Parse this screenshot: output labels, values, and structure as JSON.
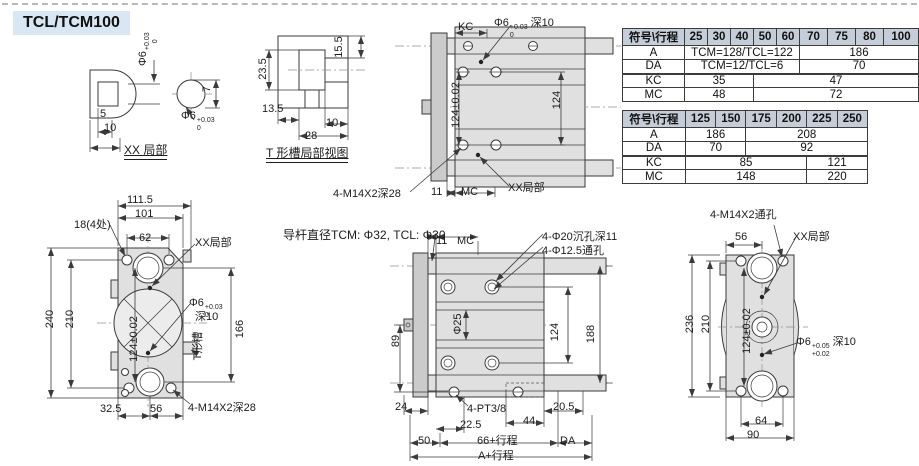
{
  "title": "TCL/TCM100",
  "colors": {
    "title_bg": "#d9e7f5",
    "table_header_bg": "#c5cdd8",
    "body_fill": "#e0e0e0",
    "line_color": "#3a3a3a"
  },
  "tables": {
    "t1": {
      "header": [
        "符号\\行程",
        "25",
        "30",
        "40",
        "50",
        "60",
        "70",
        "75",
        "80",
        "100"
      ],
      "rows": {
        "a": {
          "label": "A",
          "c1": "TCM=128/TCL=122",
          "c2": "186"
        },
        "da": {
          "label": "DA",
          "c1": "TCM=12/TCL=6",
          "c2": "70"
        },
        "kc": {
          "label": "KC",
          "c1": "35",
          "c2": "47"
        },
        "mc": {
          "label": "MC",
          "c1": "48",
          "c2": "72"
        }
      }
    },
    "t2": {
      "header": [
        "符号\\行程",
        "125",
        "150",
        "175",
        "200",
        "225",
        "250"
      ],
      "rows": {
        "a": {
          "label": "A",
          "c1": "186",
          "c2": "208"
        },
        "da": {
          "label": "DA",
          "c1": "70",
          "c2": "92"
        },
        "kc": {
          "label": "KC",
          "c1": "85",
          "c2": "121"
        },
        "mc": {
          "label": "MC",
          "c1": "148",
          "c2": "220"
        }
      }
    }
  },
  "views": {
    "xx": {
      "label": "XX 局部",
      "dim5": "5",
      "dim10": "10",
      "dim7": "7",
      "phi6_vert": {
        "base": "Φ6",
        "sup": "+0.03",
        "sub": "0"
      },
      "phi6_circle": {
        "base": "Φ6",
        "sup": "+0.03",
        "sub": "0"
      }
    },
    "tslot": {
      "label": "T 形槽局部视图",
      "dim235": "23.5",
      "dim155": "15.5",
      "dim135": "13.5",
      "dim10": "10",
      "dim28": "28"
    },
    "plan": {
      "kc": "KC",
      "phi6": {
        "base": "Φ6",
        "sup": "+0.03",
        "sub": "0",
        "suffix": "深10"
      },
      "dim124tol": "124±0.02",
      "dim124": "124",
      "m14": "4-M14X2深28",
      "dim11": "11",
      "mc": "MC",
      "xx": "XX局部"
    },
    "front": {
      "dim1115": "111.5",
      "dim101": "101",
      "dim18": "18(4处)",
      "dim62": "62",
      "xx": "XX局部",
      "dim240": "240",
      "dim210": "210",
      "dim124tol": "124±0.02",
      "phi6": {
        "base": "Φ6",
        "sup": "+0.03",
        "sub": "0"
      },
      "depth": "深10",
      "dim166": "166",
      "tslot": "T形槽",
      "dim325": "32.5",
      "dim56": "56",
      "m14": "4-M14X2深28"
    },
    "side": {
      "rod_note": "导杆直径TCM: Φ32, TCL: Φ30",
      "dim11": "11",
      "mc": "MC",
      "cbore": "4-Φ20沉孔深11",
      "thru": "4-Φ12.5通孔",
      "phi25": "Φ25",
      "dim124": "124",
      "dim188": "188",
      "dim89": "89",
      "dim24": "24",
      "pt38": "4-PT3/8",
      "dim205": "20.5",
      "dim225": "22.5",
      "dim44": "44",
      "dim50": "50",
      "stroke66": "66+行程",
      "da": "DA",
      "strokeA": "A+行程"
    },
    "end": {
      "m14": "4-M14X2通孔",
      "dim56": "56",
      "xx": "XX局部",
      "dim236": "236",
      "dim210": "210",
      "dim124tol": "124±0.02",
      "phi6": {
        "base": "Φ6",
        "sup": "+0.05",
        "sub": "+0.02",
        "suffix": "深10"
      },
      "dim64": "64",
      "dim90": "90"
    }
  }
}
